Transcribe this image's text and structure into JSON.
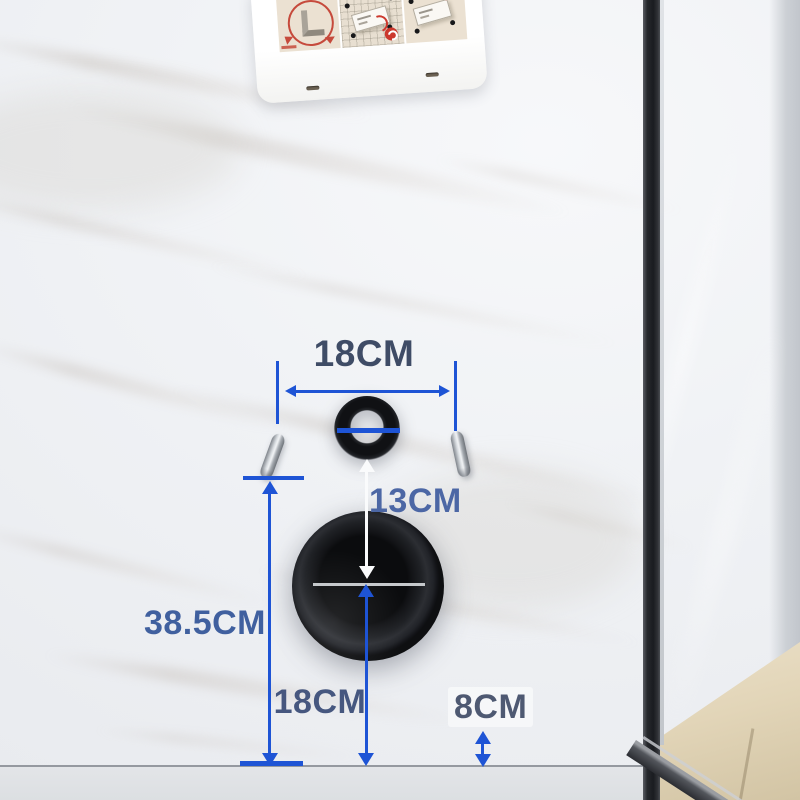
{
  "scene": {
    "title": "Wall-hung toilet installation dimensions",
    "surface": "white marble bathroom wall with glass partition",
    "unit": "CM"
  },
  "theme": {
    "accent_blue": "#1e54d5",
    "wall_base": "#f0f2f5",
    "floor_gray": "#dcdfe2",
    "frame_black": "#1a1c20",
    "glass_floor_beige": "#e2d5b8",
    "fixture_black": "#121316",
    "marker_white": "#fafbfc"
  },
  "dimensions": [
    {
      "name": "bolt-spacing",
      "label": "18CM",
      "label_color": "#3f4c66",
      "direction": "horizontal"
    },
    {
      "name": "inlet-to-outlet",
      "label": "13CM",
      "label_color": "#4c67a5",
      "direction": "vertical"
    },
    {
      "name": "bolt-height-to-floor",
      "label": "38.5CM",
      "label_color": "#40609f",
      "direction": "vertical"
    },
    {
      "name": "outlet-height-to-floor",
      "label": "18CM",
      "label_color": "#46577f",
      "direction": "vertical"
    },
    {
      "name": "side-clearance-to-floor",
      "label": "8CM",
      "label_color": "#4e5972",
      "direction": "vertical"
    }
  ],
  "objects": {
    "instruction_card": {
      "panels": [
        {
          "icon": "corner-bracket-seal-diagram"
        },
        {
          "icon": "mounting-plate-on-grid-diagram"
        },
        {
          "icon": "mounting-plate-trowel-diagram"
        }
      ]
    },
    "water_inlet_ring": {
      "color": "#121316"
    },
    "mounting_bolts": {
      "count": 2,
      "color": "silver"
    },
    "waste_outlet_flange": {
      "color": "#0c0d0f"
    },
    "glass_partition_frame": {
      "color": "#1a1c20"
    }
  }
}
